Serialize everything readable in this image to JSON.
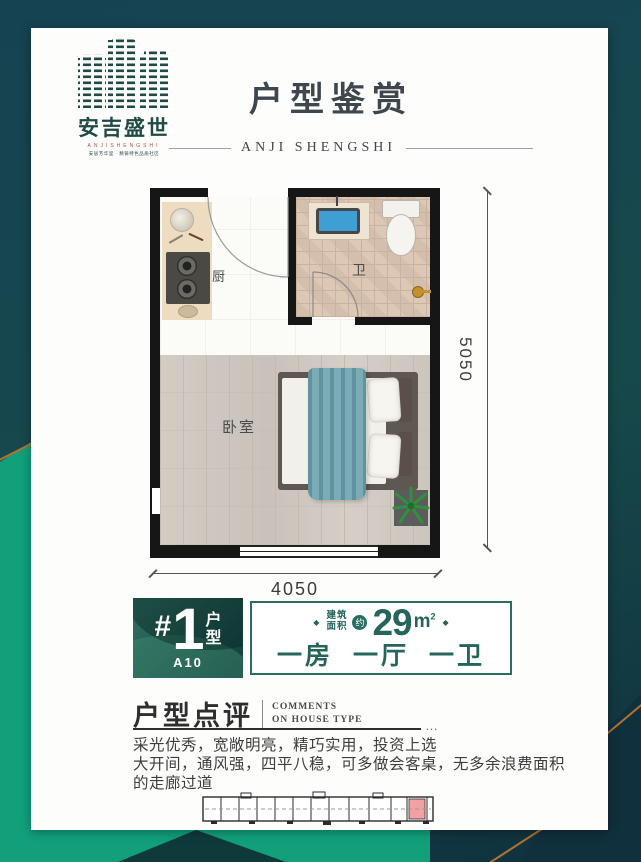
{
  "logo": {
    "name": "安吉盛世",
    "latin": "ANJISHENGSHI",
    "tagline": "安居芳华里 · 精铸特色品质社区"
  },
  "header": {
    "title": "户型鉴赏",
    "subtitle": "ANJI SHENGSHI"
  },
  "floorplan": {
    "kitchen_label": "厨",
    "bath_label": "卫",
    "bedroom_label": "卧室",
    "dim_height": "5050",
    "dim_width": "4050"
  },
  "unit_badge": {
    "hash": "#",
    "number": "1",
    "type_char_1": "户",
    "type_char_2": "型",
    "code": "A10"
  },
  "area_box": {
    "diamond": "◆",
    "label_line1": "建筑",
    "label_line2": "面积",
    "approx": "约",
    "value": "29",
    "unit": "m",
    "unit_sup": "2",
    "layout": "一房 一厅 一卫"
  },
  "comments": {
    "title": "户型点评",
    "en_line1": "COMMENTS",
    "en_line2": "ON HOUSE TYPE",
    "ellipsis": "…",
    "line1": "采光优秀，宽敞明亮，精巧实用，投资上选",
    "line2": "大开间，通风强，四平八稳，可多做会客桌，无多余浪费面积的走廊过道"
  },
  "colors": {
    "teal_dark": "#143f48",
    "emerald": "#12a07b",
    "copper": "#b5712e",
    "accent_text": "#25655c",
    "highlight_unit": "#f2a0a4"
  }
}
